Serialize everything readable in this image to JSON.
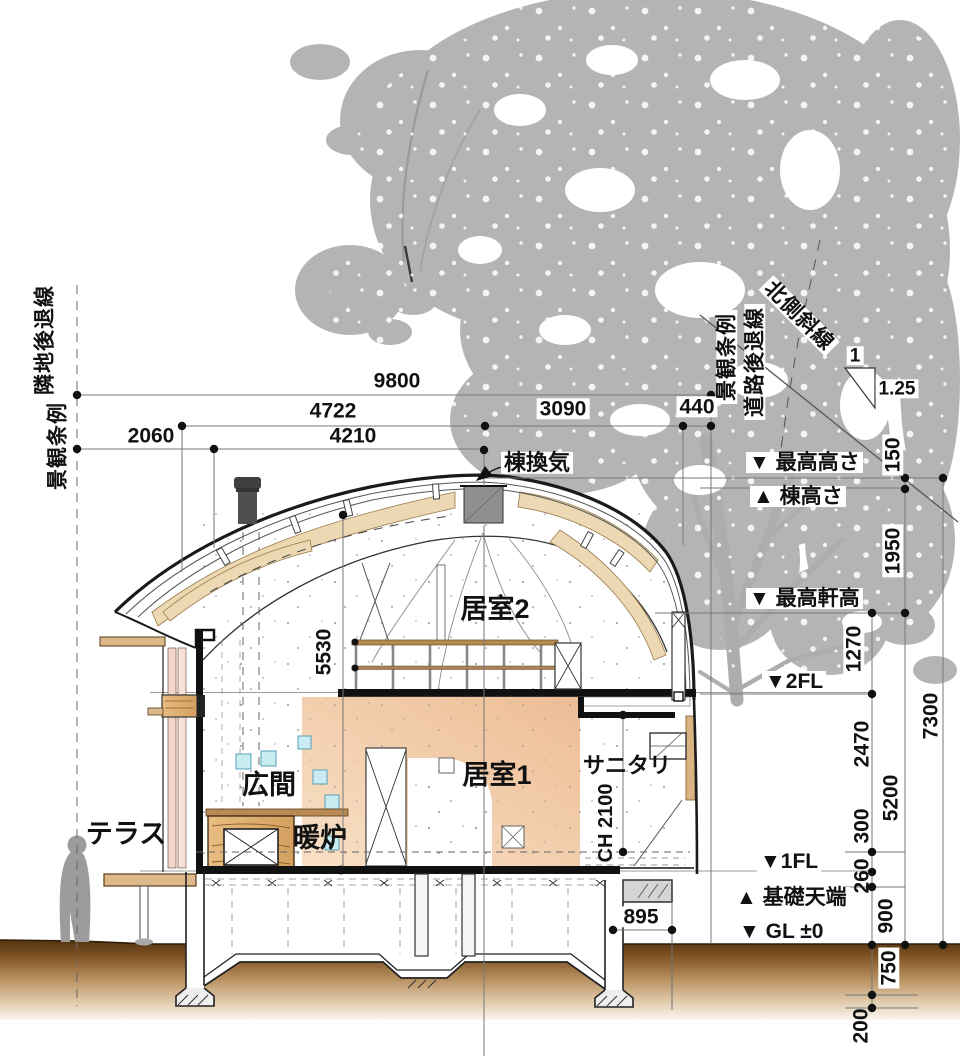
{
  "labels": {
    "rooms": {
      "terrace": "テラス",
      "hall": "広間",
      "fireplace": "暖炉",
      "room1": "居室1",
      "room2": "居室2",
      "sanitary": "サニタリ",
      "ridge_vent": "棟換気"
    },
    "levels": {
      "max_height": "▼ 最高高さ",
      "ridge_height": "▲ 棟高さ",
      "max_eave_height": "▼ 最高軒高",
      "fl2": "▼2FL",
      "fl1": "▼1FL",
      "foundation_top": "▲ 基礎天端",
      "gl": "▼ GL ±0"
    },
    "setbacks": {
      "left_ordinance": "景観条例",
      "left_setback": "隣地後退線",
      "right_ordinance": "景観条例",
      "right_setback": "道路後退線",
      "north_slope": "北側斜線"
    },
    "slope": {
      "run": "1",
      "rise": "1.25"
    },
    "ceiling_height": "CH 2100"
  },
  "dimensions": {
    "horizontal": {
      "overall": "9800",
      "left_span": "4722",
      "inner_span": "4210",
      "right_span": "3090",
      "road_setback": "440",
      "terrace": "2060",
      "foundation_offset": "895"
    },
    "vertical": {
      "ridge_clearance": "150",
      "ridge_to_eave": "1950",
      "eave_to_2fl": "1270",
      "overall_height": "7300",
      "fl2_span": "2470",
      "eave_to_gl": "5200",
      "floor_buildup": "300",
      "fl1_to_foundation": "260",
      "foundation_to_gl": "900",
      "gl_to_footing": "750",
      "footing_thickness": "200",
      "void_height": "5530"
    }
  },
  "colors": {
    "tree": "#b4b4b4",
    "wood_rafter": "#ecd9b4",
    "room_wall": "#edbd95",
    "glass_block": "#c9ecf2",
    "ground": "#8a5a2a",
    "line": "#1a1a1a",
    "dim_line": "#777777"
  }
}
